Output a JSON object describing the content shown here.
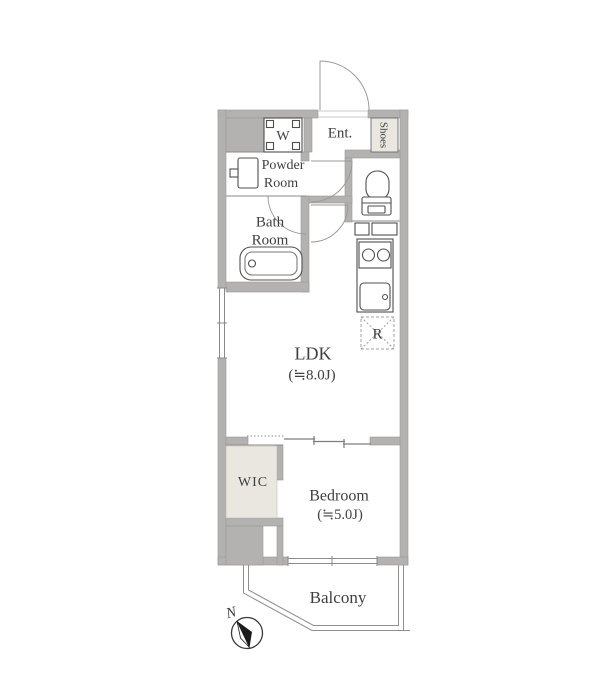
{
  "rooms": {
    "entrance": {
      "label": "Ent."
    },
    "shoes": {
      "label": "Shoes"
    },
    "laundry": {
      "label": "W"
    },
    "powder_room": {
      "line1": "Powder",
      "line2": "Room"
    },
    "bath_room": {
      "line1": "Bath",
      "line2": "Room"
    },
    "ldk": {
      "label": "LDK",
      "size": "(≒8.0J)"
    },
    "refrigerator": {
      "label": "R"
    },
    "wic": {
      "label": "WIC"
    },
    "bedroom": {
      "label": "Bedroom",
      "size": "(≒5.0J)"
    },
    "balcony": {
      "label": "Balcony"
    }
  },
  "compass": {
    "north": "N"
  },
  "colors": {
    "wall": "#b3b2b0",
    "closet_fill": "#eae7e1",
    "floor": "#ffffff",
    "fixture_line": "#4f4f4f",
    "door_line": "#9a9a9a",
    "thin_line": "#8a8a8a",
    "text": "#3f3f3f"
  }
}
